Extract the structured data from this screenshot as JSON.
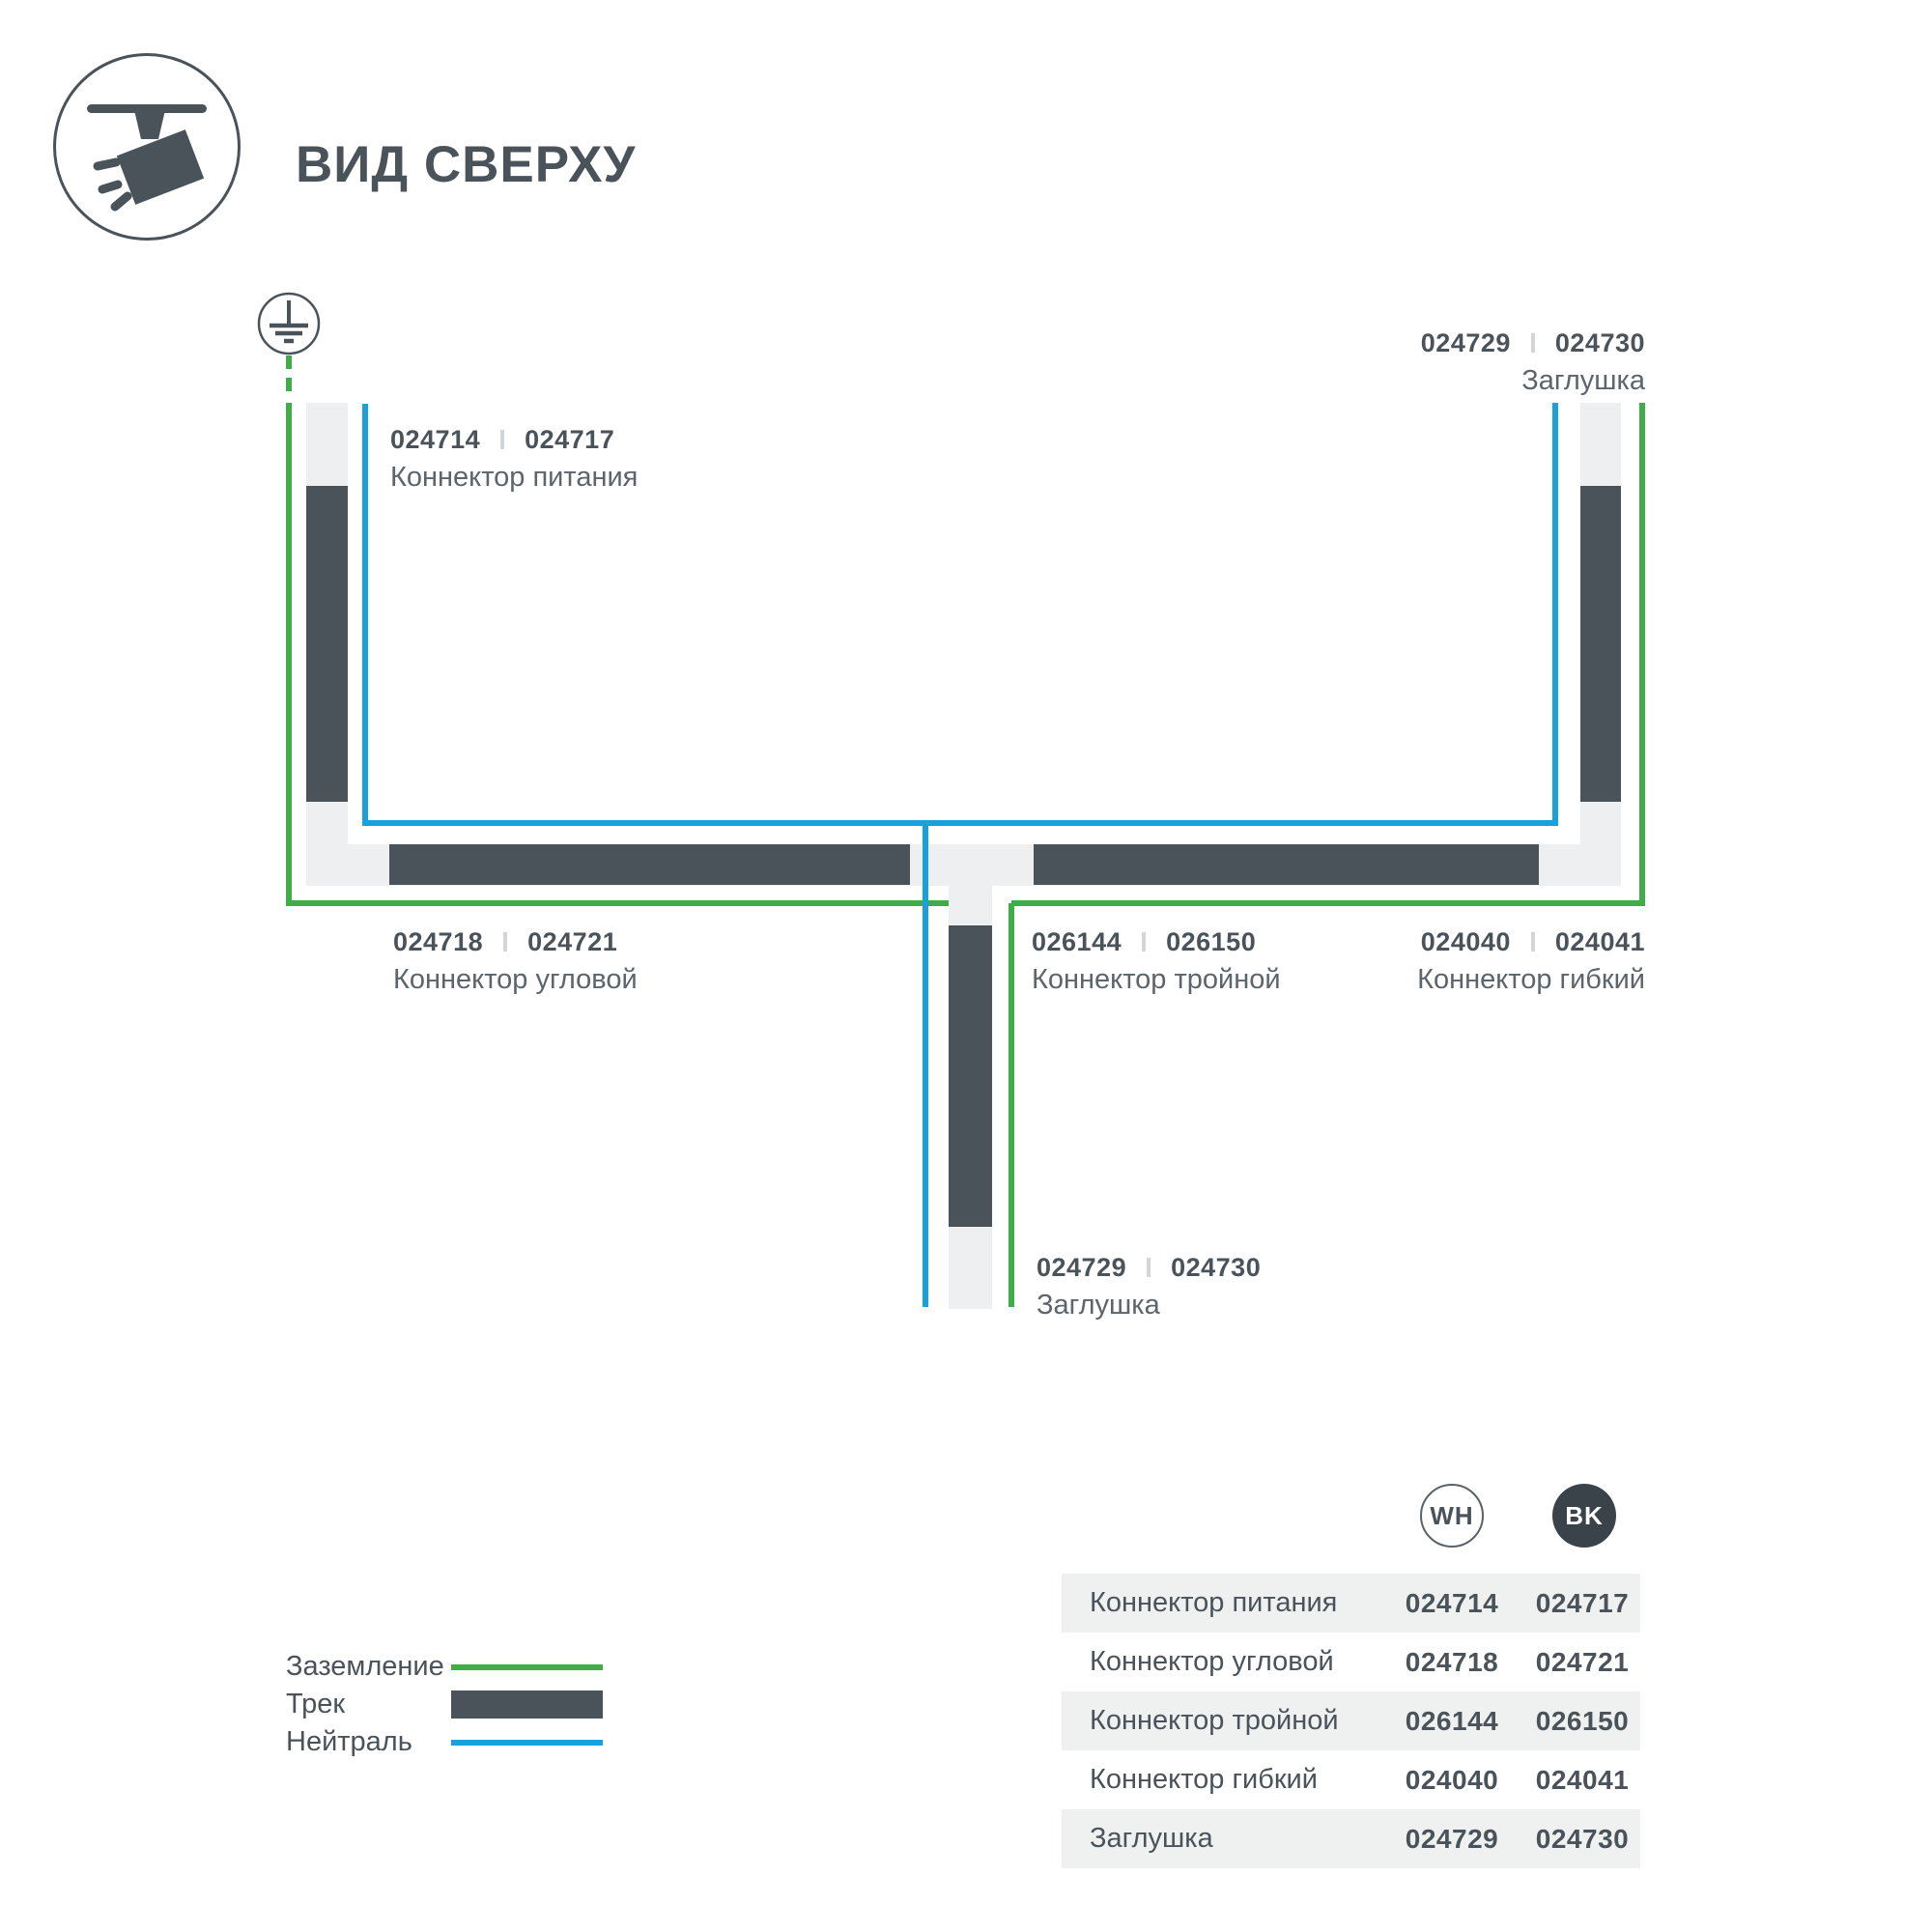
{
  "page": {
    "title": "ВИД СВЕРХУ"
  },
  "colors": {
    "track_dark": "#4A525A",
    "connector_light": "#EDEFF0",
    "ground_green": "#3FAE49",
    "neutral_blue": "#18A1DC",
    "table_row_gray": "#EFF1F1",
    "text_primary": "#4A525A",
    "text_secondary": "#5C646C"
  },
  "diagram": {
    "parts": {
      "power": {
        "code_wh": "024714",
        "code_bk": "024717",
        "name": "Коннектор питания"
      },
      "corner": {
        "code_wh": "024718",
        "code_bk": "024721",
        "name": "Коннектор угловой"
      },
      "triple": {
        "code_wh": "026144",
        "code_bk": "026150",
        "name": "Коннектор тройной"
      },
      "flex": {
        "code_wh": "024040",
        "code_bk": "024041",
        "name": "Коннектор гибкий"
      },
      "cap_top": {
        "code_wh": "024729",
        "code_bk": "024730",
        "name": "Заглушка"
      },
      "cap_bottom": {
        "code_wh": "024729",
        "code_bk": "024730",
        "name": "Заглушка"
      }
    }
  },
  "legend": {
    "items": [
      {
        "label": "Заземление",
        "swatch": "ground-line"
      },
      {
        "label": "Трек",
        "swatch": "track-bar"
      },
      {
        "label": "Нейтраль",
        "swatch": "neutral-line"
      }
    ]
  },
  "table": {
    "columns": {
      "wh": "WH",
      "bk": "BK"
    },
    "rows": [
      {
        "name": "Коннектор питания",
        "wh": "024714",
        "bk": "024717"
      },
      {
        "name": "Коннектор угловой",
        "wh": "024718",
        "bk": "024721"
      },
      {
        "name": "Коннектор тройной",
        "wh": "026144",
        "bk": "026150"
      },
      {
        "name": "Коннектор гибкий",
        "wh": "024040",
        "bk": "024041"
      },
      {
        "name": "Заглушка",
        "wh": "024729",
        "bk": "024730"
      }
    ]
  }
}
